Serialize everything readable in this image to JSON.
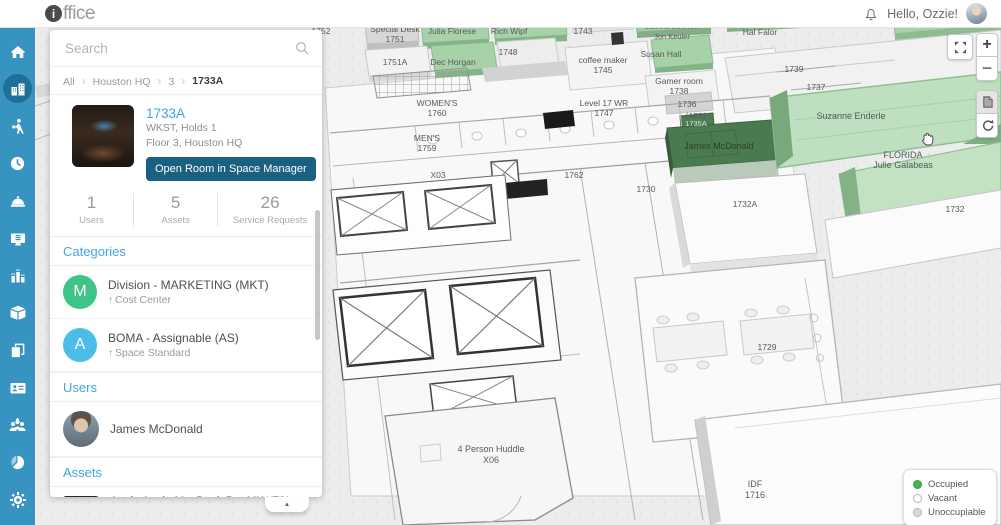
{
  "header": {
    "logo_i": "i",
    "logo_rest": "ffice",
    "greeting": "Hello, Ozzie!"
  },
  "sidebar": {
    "icons": [
      "home",
      "buildings",
      "visitor-walking",
      "clock",
      "service-bell",
      "it-monitor",
      "utilization-chart",
      "package-cube",
      "copy-pages",
      "id-badge",
      "people-group",
      "pie-chart",
      "gear"
    ]
  },
  "panel": {
    "search_placeholder": "Search",
    "breadcrumb": [
      "All",
      "Houston HQ",
      "3",
      "1733A"
    ],
    "room": {
      "name": "1733A",
      "type": "WKST, Holds 1",
      "location": "Floor 3, Houston HQ",
      "open_button": "Open Room in Space Manager"
    },
    "stats": [
      {
        "value": "1",
        "label": "Users"
      },
      {
        "value": "5",
        "label": "Assets"
      },
      {
        "value": "26",
        "label": "Service Requests"
      }
    ],
    "categories": {
      "title": "Categories",
      "items": [
        {
          "initial": "M",
          "color": "#3ec487",
          "title": "Division - MARKETING (MKT)",
          "subtitle": "Cost Center"
        },
        {
          "initial": "A",
          "color": "#4bbde8",
          "title": "BOMA - Assignable (AS)",
          "subtitle": "Space Standard"
        }
      ]
    },
    "users": {
      "title": "Users",
      "items": [
        {
          "name": "James McDonald"
        }
      ]
    },
    "assets": {
      "title": "Assets",
      "items": [
        {
          "title": "Apple Apple MacBook Pro MLW72LL/A 15.4-...",
          "type": "Computer",
          "owner": "Owner: James McDonald"
        }
      ]
    },
    "collapse_icon": "▲"
  },
  "map": {
    "controls": {
      "zoom_in": "+",
      "zoom_out": "−"
    },
    "legend": [
      {
        "label": "Occupied",
        "color": "#4caf50"
      },
      {
        "label": "Vacant",
        "color": "#ffffff"
      },
      {
        "label": "Unoccupiable",
        "color": "#d8d8d8"
      }
    ],
    "labels": [
      {
        "text": "1752"
      },
      {
        "text": "Special Desk",
        "text2": "1751"
      },
      {
        "text": "Julia Florese"
      },
      {
        "text": "Rich Wipf"
      },
      {
        "text": "1743"
      },
      {
        "text": "Jaunna Boswert",
        "text2": "Jon Keuler"
      },
      {
        "text": "Hal Falor"
      },
      {
        "text": "1751A"
      },
      {
        "text": "Dec Horgan"
      },
      {
        "text": "1748"
      },
      {
        "text": "coffee maker",
        "text2": "1745"
      },
      {
        "text": "Susan Hall"
      },
      {
        "text": "Gamer room",
        "text2": "1738"
      },
      {
        "text": "1739"
      },
      {
        "text": "1737"
      },
      {
        "text": "1736"
      },
      {
        "text": "(AED)",
        "text2": "1735A"
      },
      {
        "text": "Suzanne Enderle"
      },
      {
        "text": "James McDonald"
      },
      {
        "text": "FLORIDA",
        "text2": "Julie Galabeas"
      },
      {
        "text": "WOMEN'S",
        "text2": "1760"
      },
      {
        "text": "MEN'S",
        "text2": "1759"
      },
      {
        "text": "Level 17 WR",
        "text2": "1747"
      },
      {
        "text": "X03"
      },
      {
        "text": "1762"
      },
      {
        "text": "1730"
      },
      {
        "text": "1732A"
      },
      {
        "text": "1732"
      },
      {
        "text": "1729"
      },
      {
        "text": "4 Person Huddle",
        "text2": "X06"
      },
      {
        "text": "IDF",
        "text2": "1716"
      }
    ]
  },
  "colors": {
    "sidebar_blue": "#3793c0",
    "accent_blue": "#41a6e0",
    "button_teal": "#1a6080",
    "occupied_light_green": "#bfe0c0",
    "selected_dark_green": "#4a7b50"
  }
}
